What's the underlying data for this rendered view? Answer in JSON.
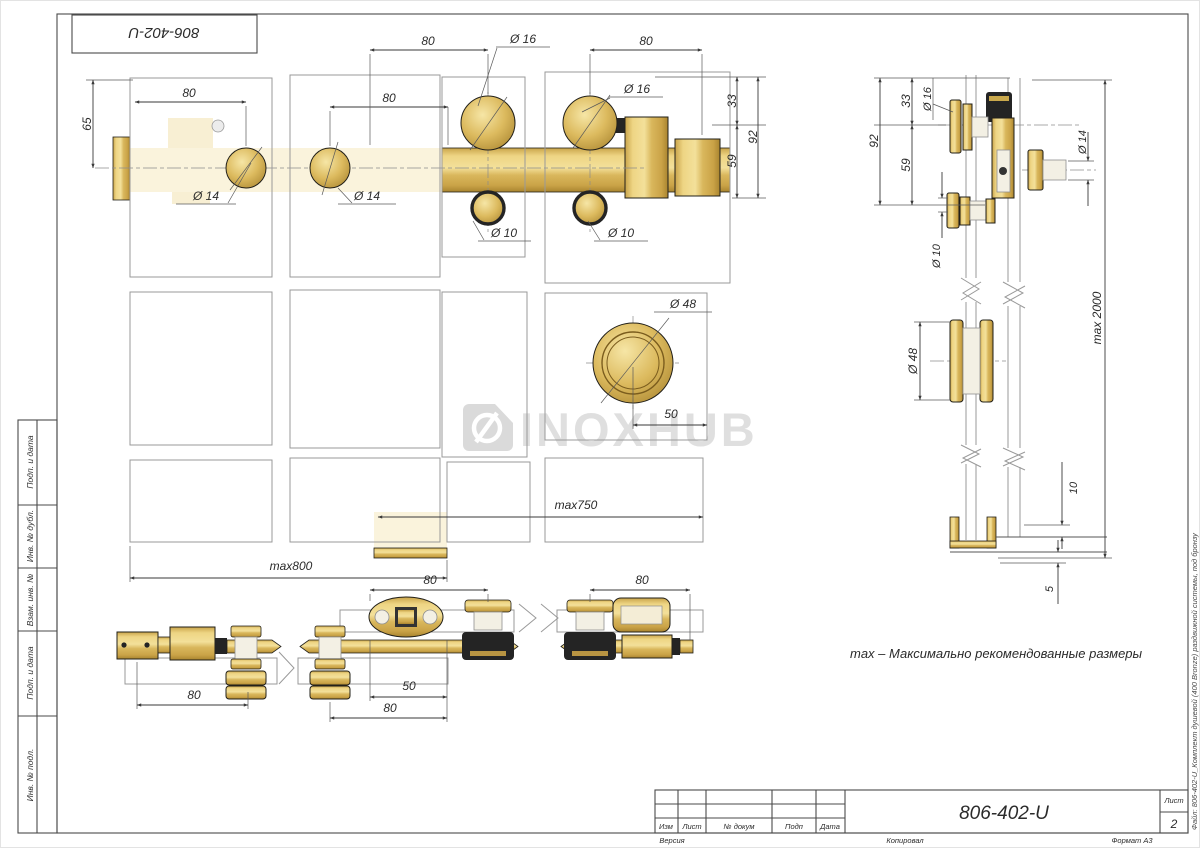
{
  "page": {
    "stamp": "806-402-U",
    "watermark": "INOXHUB",
    "note": "max – Максимально рекомендованные размеры",
    "file_note": "Файл: 806-402-U_Комплект душевой (400 Bronze) раздвижной системы, под бронзу"
  },
  "title_block": {
    "doc_number": "806-402-U",
    "col_izm": "Изм",
    "col_list": "Лист",
    "col_docnum": "№ докум",
    "col_podp": "Подп",
    "col_data": "Дата",
    "sheet_label": "Лист",
    "sheet_number": "2",
    "version": "Версия",
    "copied": "Копировал",
    "format": "Формат А3"
  },
  "side_columns": [
    "Подп. и дата",
    "Инв. № дубл.",
    "Взам. инв. №",
    "Подп. и дата",
    "Инв. № подл."
  ],
  "dims": {
    "d80": "80",
    "d65": "65",
    "d33": "33",
    "d59": "59",
    "d92": "92",
    "d50": "50",
    "d10": "10",
    "d5": "5",
    "dia14": "Ø 14",
    "dia16": "Ø 16",
    "dia10": "Ø 10",
    "dia48": "Ø 48",
    "max750": "max750",
    "max800": "max800",
    "max2000": "max 2000"
  },
  "colors": {
    "brass": "#d9b65a",
    "brass_light": "#f3e09a",
    "brass_dark": "#a9842f",
    "glass_tint": "#faf3dc",
    "rubber": "#242424",
    "watermark": "#c6c6c6"
  }
}
